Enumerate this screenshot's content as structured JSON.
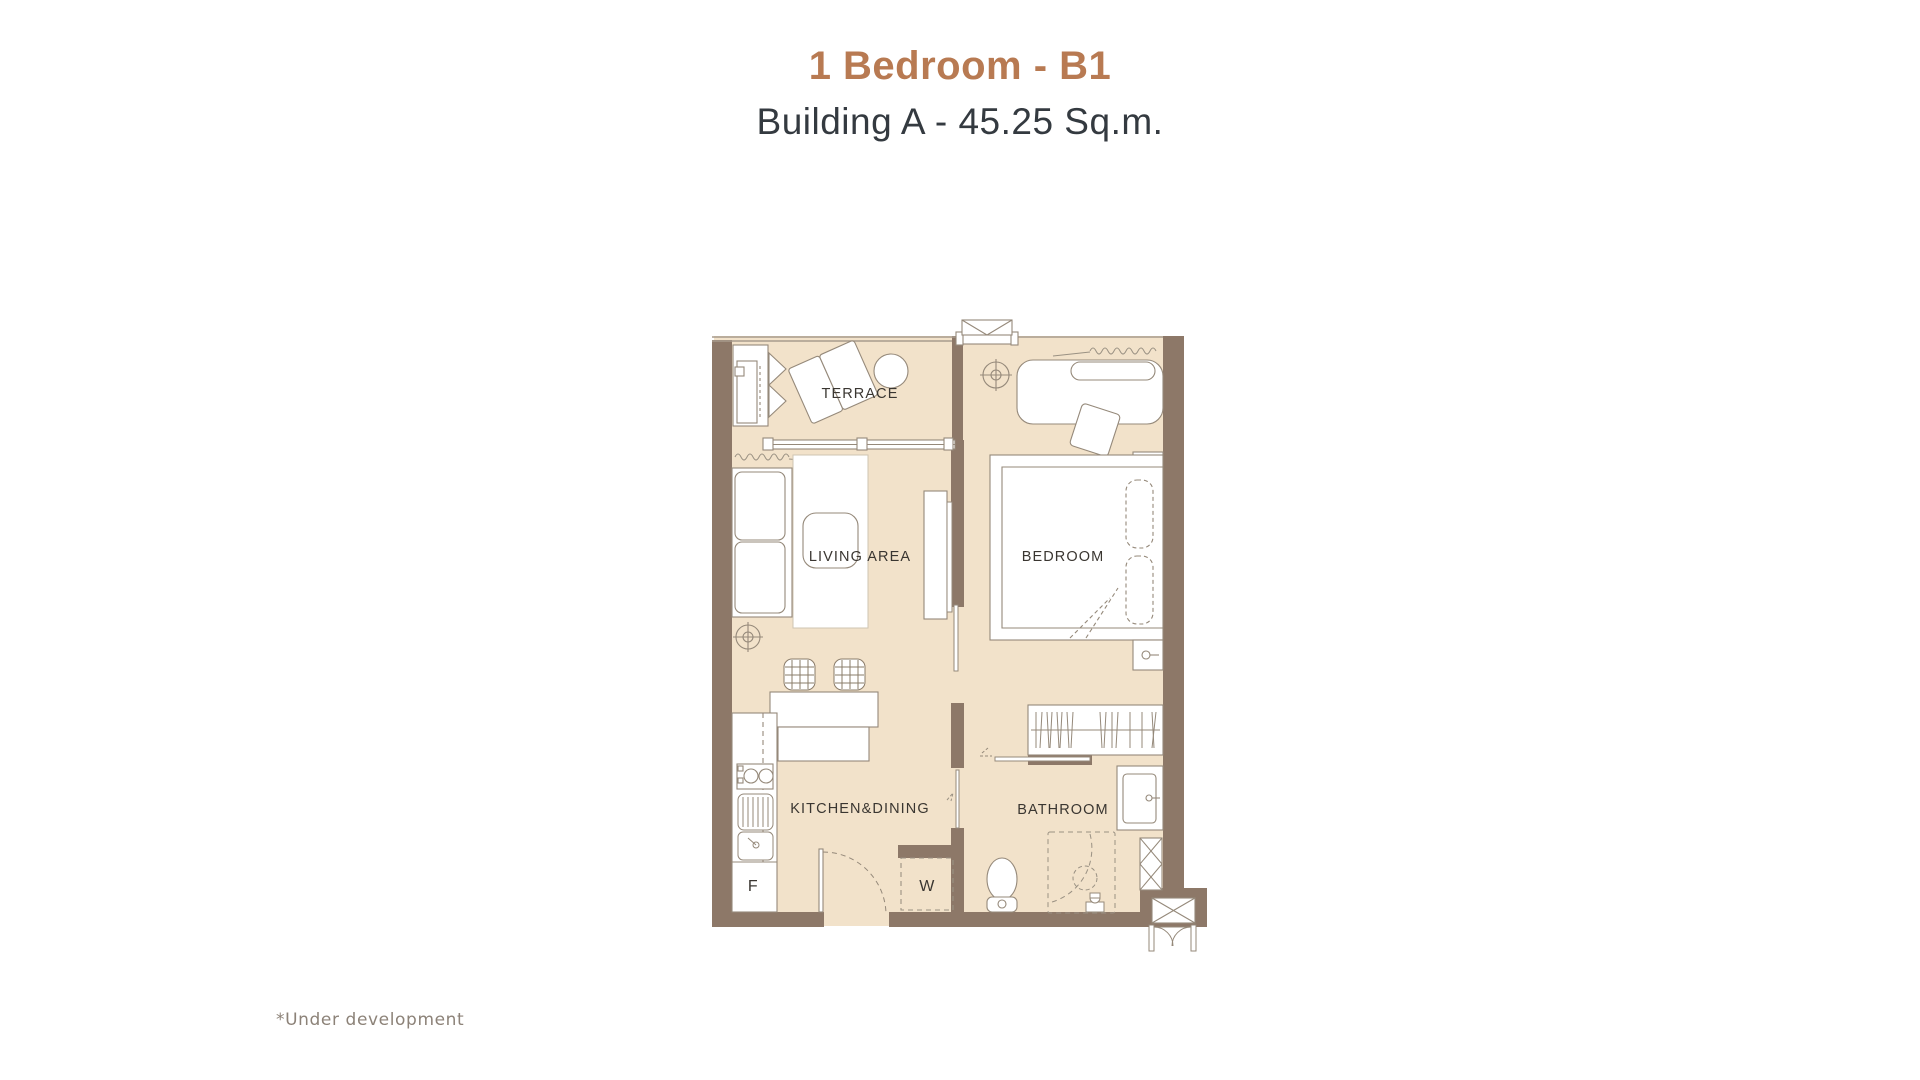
{
  "header": {
    "title": "1 Bedroom - B1",
    "subtitle": "Building A - 45.25 Sq.m."
  },
  "floorplan": {
    "rooms": {
      "terrace": "TERRACE",
      "living": "LIVING AREA",
      "bedroom": "BEDROOM",
      "kitchen": "KITCHEN&DINING",
      "bathroom": "BATHROOM"
    },
    "markers": {
      "fridge": "F",
      "washer": "W"
    }
  },
  "footnote": "*Under development",
  "colors": {
    "accent_title": "#b87a52",
    "subtitle_text": "#343a40",
    "wall": "#8d7868",
    "floor": "#f2e2ca",
    "furniture_line": "#95897a",
    "room_label": "#3a3631",
    "footnote_text": "#8c8278"
  }
}
